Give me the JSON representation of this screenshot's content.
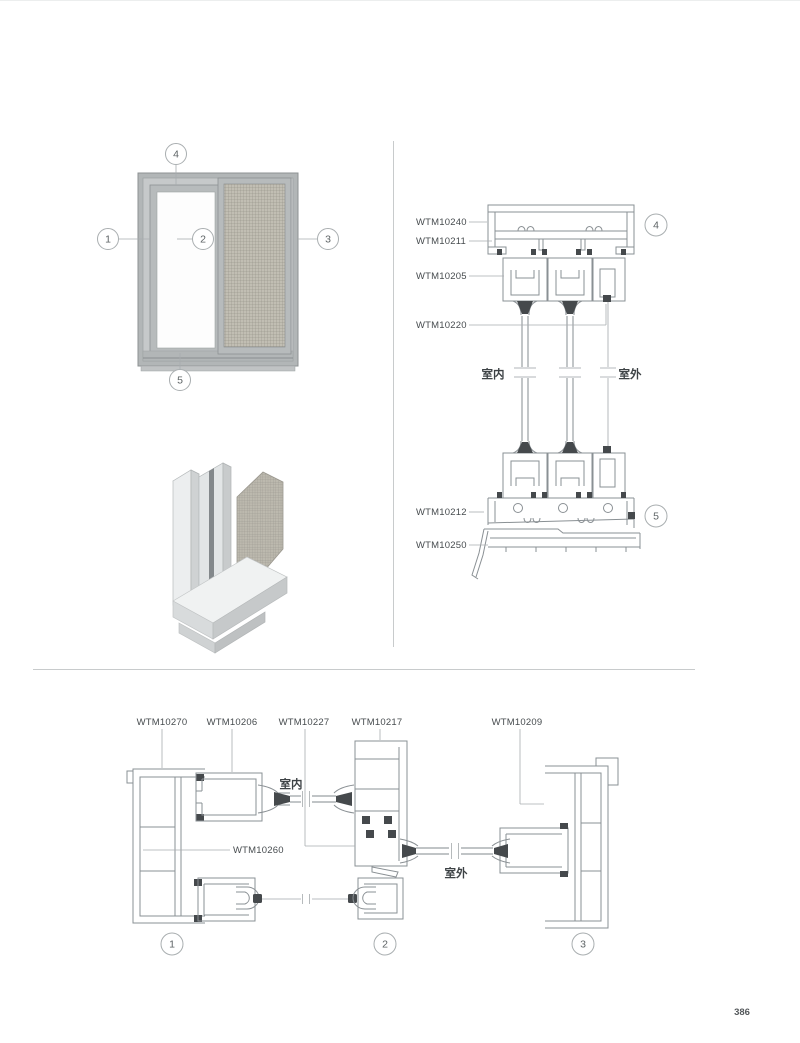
{
  "page": {
    "number": "386"
  },
  "elevation": {
    "callouts": [
      "1",
      "2",
      "3",
      "4",
      "5"
    ]
  },
  "vertical_section": {
    "parts": [
      {
        "code": "WTM10240"
      },
      {
        "code": "WTM10211"
      },
      {
        "code": "WTM10205"
      },
      {
        "code": "WTM10220"
      },
      {
        "code": "WTM10212"
      },
      {
        "code": "WTM10250"
      }
    ],
    "indoor_label": "室内",
    "outdoor_label": "室外",
    "callout_top": "4",
    "callout_bottom": "5"
  },
  "horizontal_section": {
    "parts_top": [
      "WTM10270",
      "WTM10206",
      "WTM10227",
      "WTM10217",
      "WTM10209"
    ],
    "part_mid": "WTM10260",
    "indoor_label": "室内",
    "outdoor_label": "室外",
    "callouts": [
      "1",
      "2",
      "3"
    ]
  },
  "colors": {
    "drawing_line": "#8a9094",
    "leader_line": "#a8adaf",
    "label_text": "#474c4f",
    "frame_fill": "#b2b6b7",
    "mesh_fill": "#c1beb3",
    "glass_fill": "#fdfdfd",
    "divider": "#c8cbcc"
  }
}
